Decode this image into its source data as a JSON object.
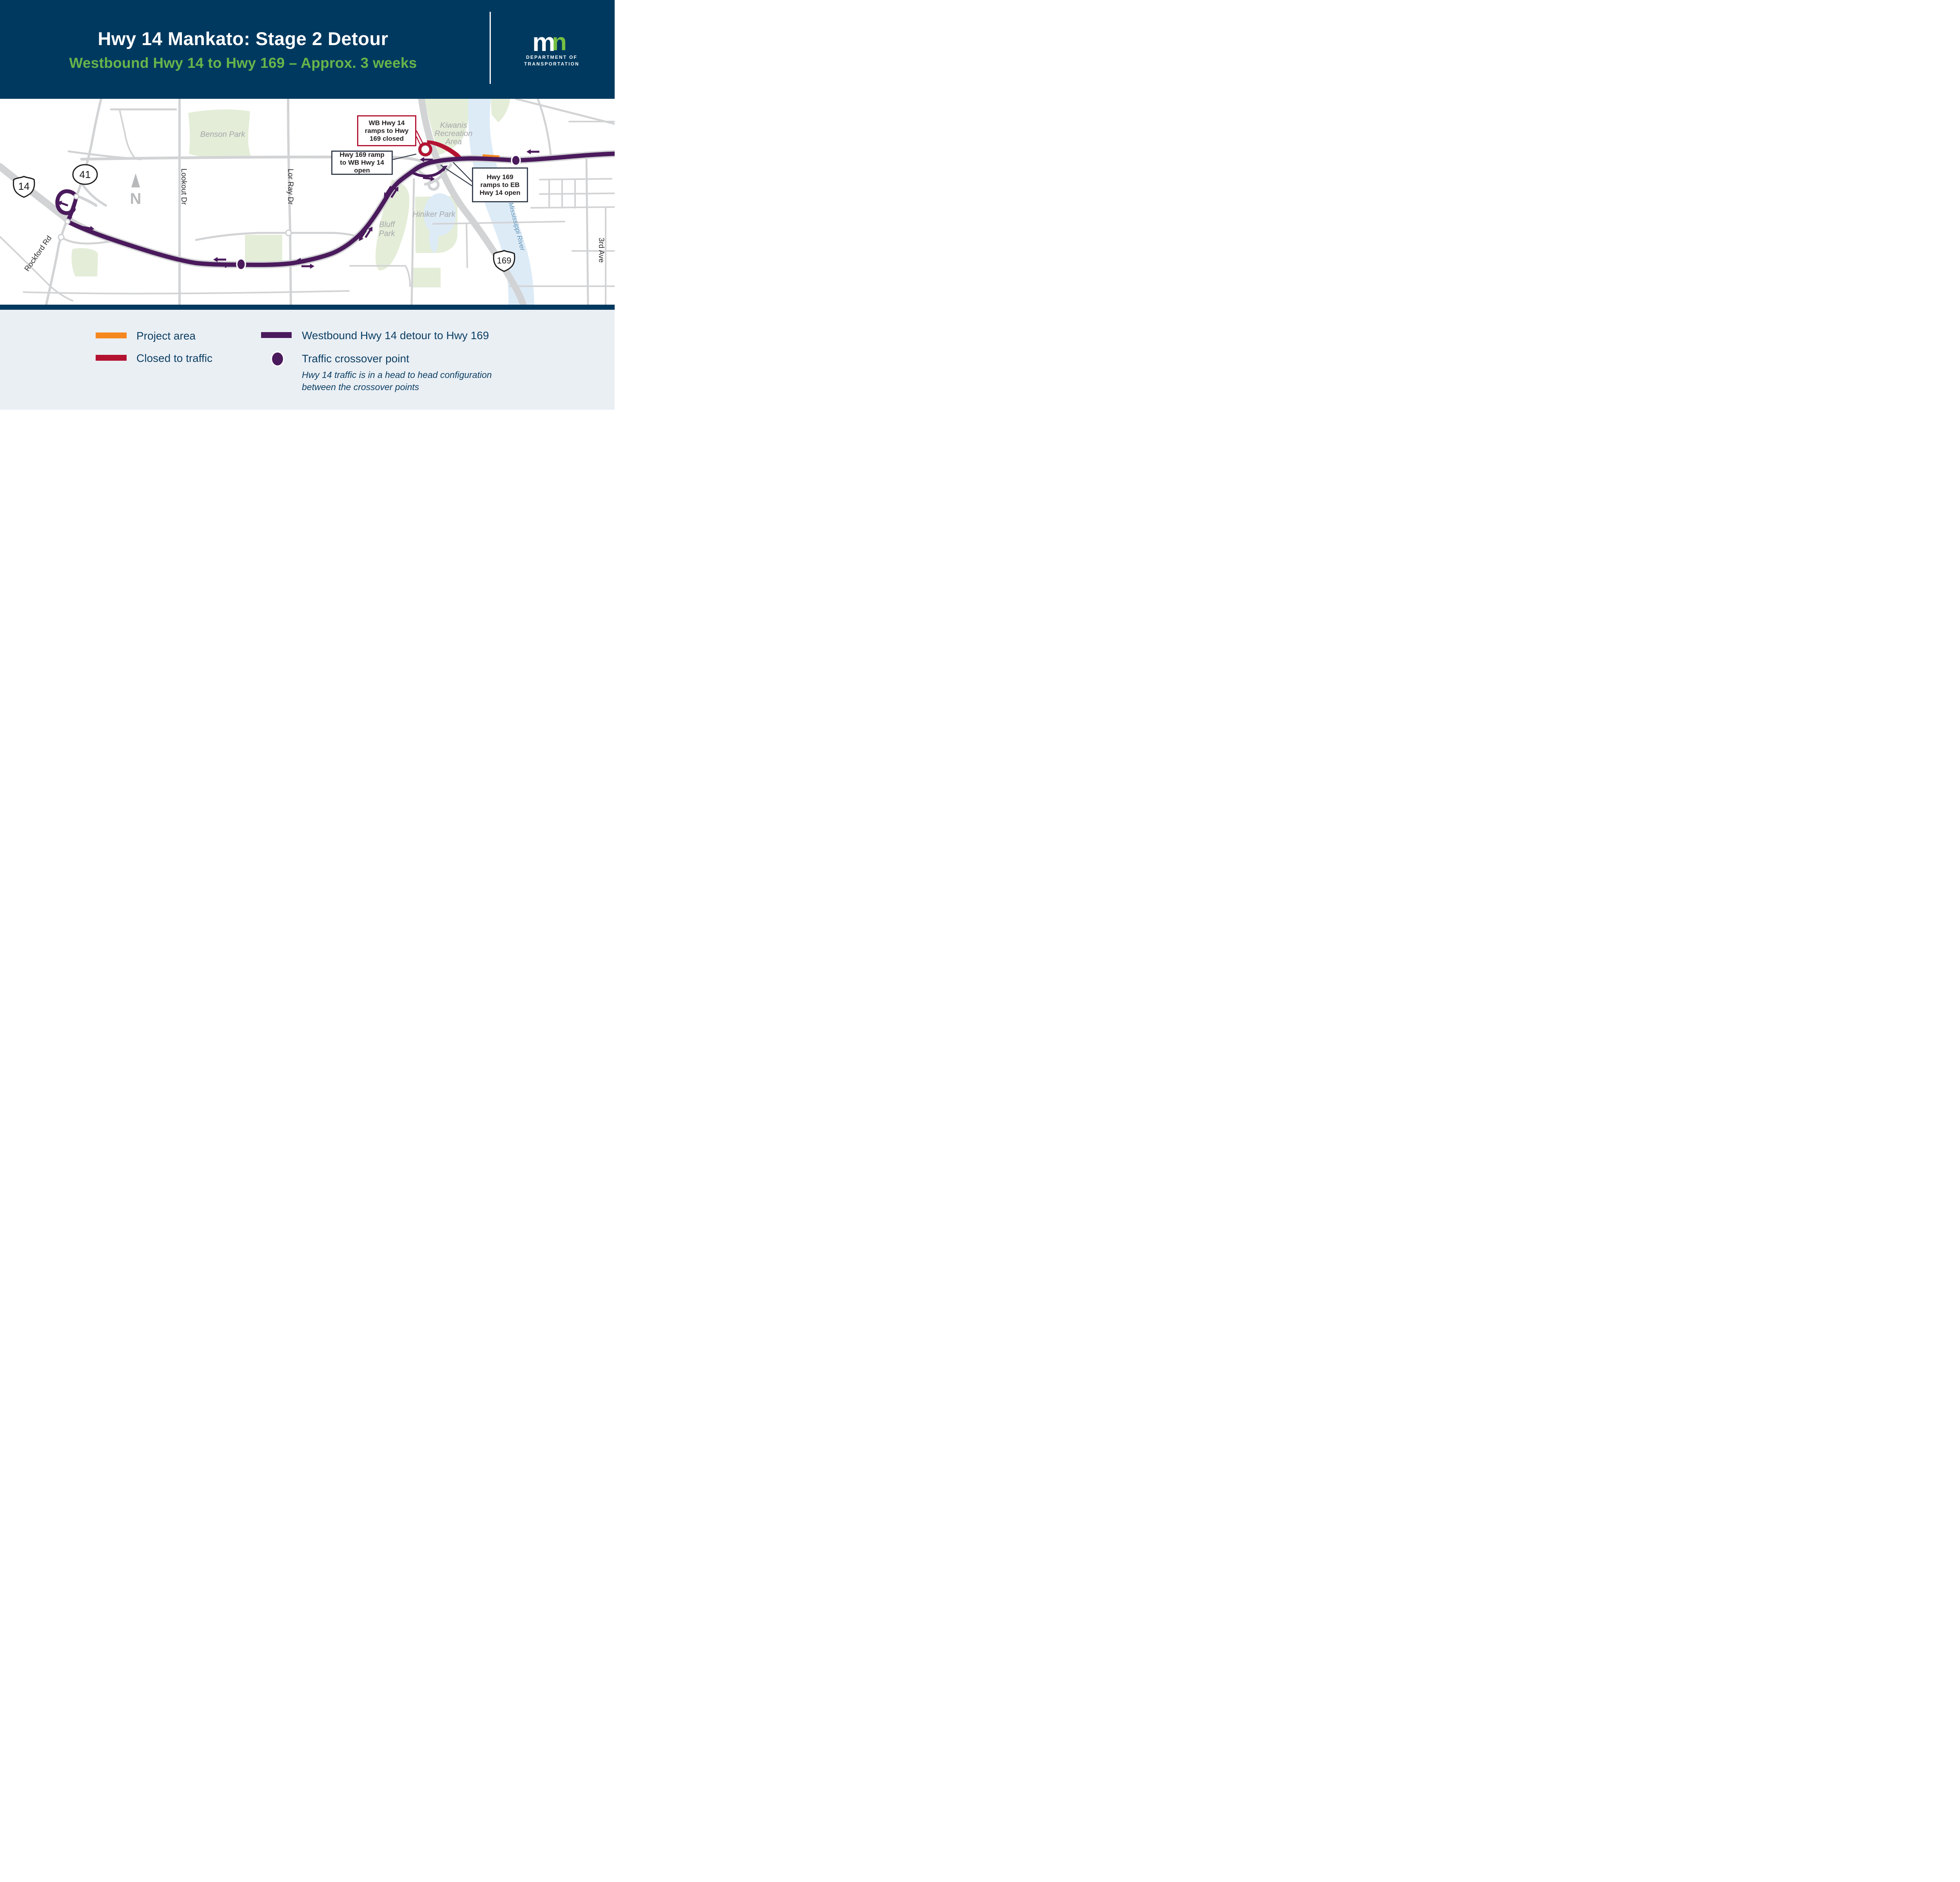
{
  "header": {
    "title": "Hwy 14 Mankato: Stage 2 Detour",
    "subtitle": "Westbound Hwy 14 to Hwy 169 – Approx. 3 weeks",
    "logo": {
      "mark_m": "m",
      "mark_n": "n",
      "dept_line1": "DEPARTMENT OF",
      "dept_line2": "TRANSPORTATION"
    }
  },
  "map": {
    "parks": {
      "benson": "Benson Park",
      "kiwanis_line1": "Kiwanis",
      "kiwanis_line2": "Recreation",
      "kiwanis_line3": "Area",
      "hiniker": "Hiniker Park",
      "bluff_line1": "Bluff",
      "bluff_line2": "Park"
    },
    "roads": {
      "lookout": "Lookout Dr",
      "lor_ray": "Lor Ray Dr",
      "rockford": "Rockford Rd",
      "third_ave": "3rd Ave"
    },
    "river": "Mississippi River",
    "shields": {
      "hwy14": "14",
      "hwy41": "41",
      "hwy169": "169"
    },
    "north_letter": "N",
    "callouts": {
      "closed_ramp": "WB Hwy 14 ramps to Hwy 169 closed",
      "wb_open": "Hwy 169 ramp to WB Hwy 14 open",
      "eb_open": "Hwy 169 ramps to EB Hwy 14 open"
    }
  },
  "legend": {
    "project_area": "Project area",
    "closed": "Closed to traffic",
    "detour": "Westbound Hwy 14 detour to Hwy 169",
    "crossover": "Traffic crossover point",
    "note_line1": "Hwy 14 traffic is in a head to head configuration",
    "note_line2": "between the crossover points"
  },
  "colors": {
    "navy": "#00395f",
    "green_text": "#66b54b",
    "logo_green": "#76bf43",
    "detour_purple": "#4a1a5c",
    "closed_red": "#b41231",
    "project_orange": "#f6871f",
    "road_gray": "#d2d3d5",
    "park_green": "#e4edd8",
    "water_blue": "#ddebf7",
    "legend_bg": "#eaeff4",
    "callout_border": "#394150",
    "gray_label": "#a4a7a9",
    "river_label": "#5e93b8"
  }
}
